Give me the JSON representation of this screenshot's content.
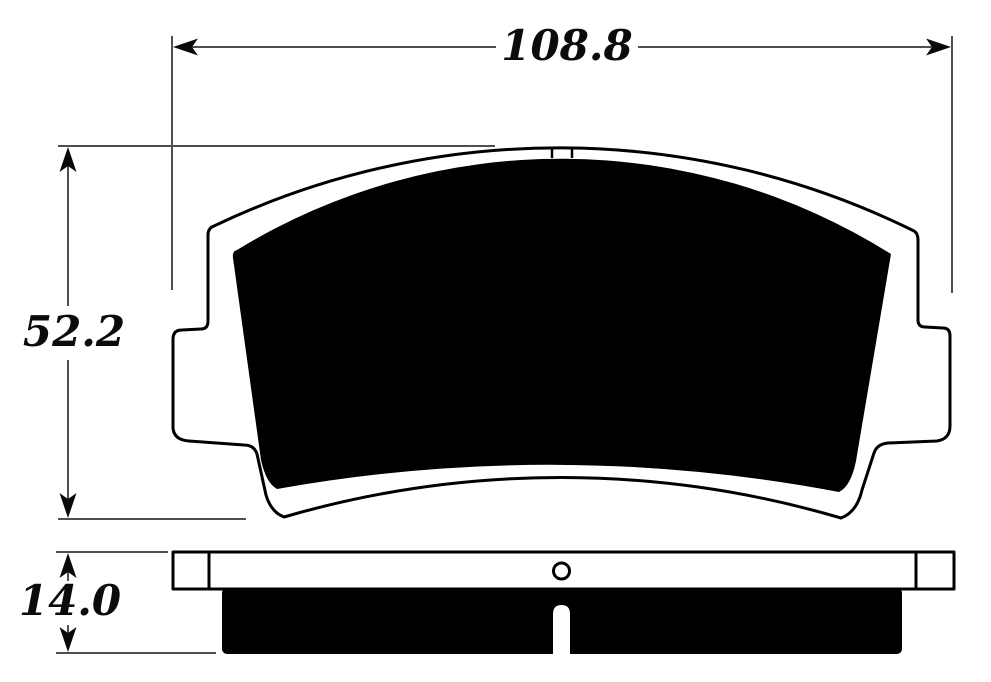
{
  "diagram": {
    "subject": "brake-pad-dimension-drawing",
    "dimensions": {
      "width": "108.8",
      "height": "52.2",
      "thickness": "14.0"
    },
    "colors": {
      "outline": "#000000",
      "dimension_line": "#4f4f4f",
      "arrow": "#0a0a0a",
      "text": "#0b0b0b",
      "background": "#ffffff"
    }
  }
}
